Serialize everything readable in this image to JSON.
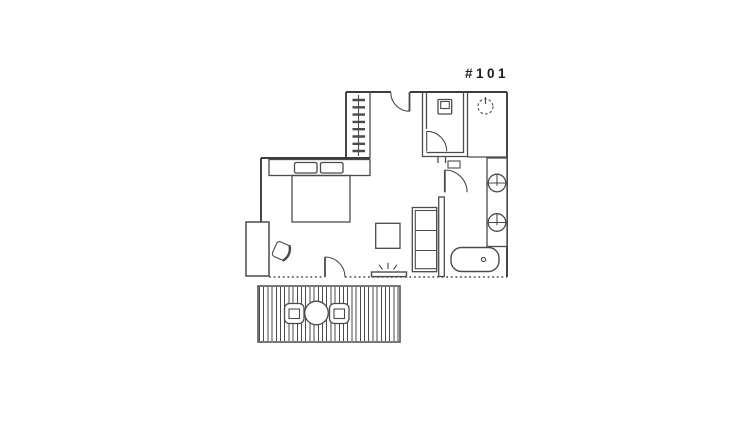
{
  "page": {
    "background": "#ffffff",
    "line_color": "#4a4a4a",
    "wall_color": "#3c3c3c",
    "text_color": "#1c1c1c"
  },
  "unit": {
    "label": "#101"
  },
  "fixtures": {
    "icon_names": [
      "closet-hangers-icon",
      "entry-door-swing-icon",
      "toilet-icon",
      "ceiling-light-icon",
      "sink-basin-icon",
      "sink-basin-icon",
      "bathtub-icon",
      "bed-with-pillows-icon",
      "desk-icon",
      "desk-chair-icon",
      "sofa-icon",
      "coffee-table-icon",
      "tv-icon",
      "terrace-door-swing-icon",
      "bathroom-door-swing-icon",
      "wc-door-swing-icon",
      "deck-decking-icon",
      "patio-table-icon",
      "patio-chair-icon",
      "patio-chair-icon"
    ]
  }
}
